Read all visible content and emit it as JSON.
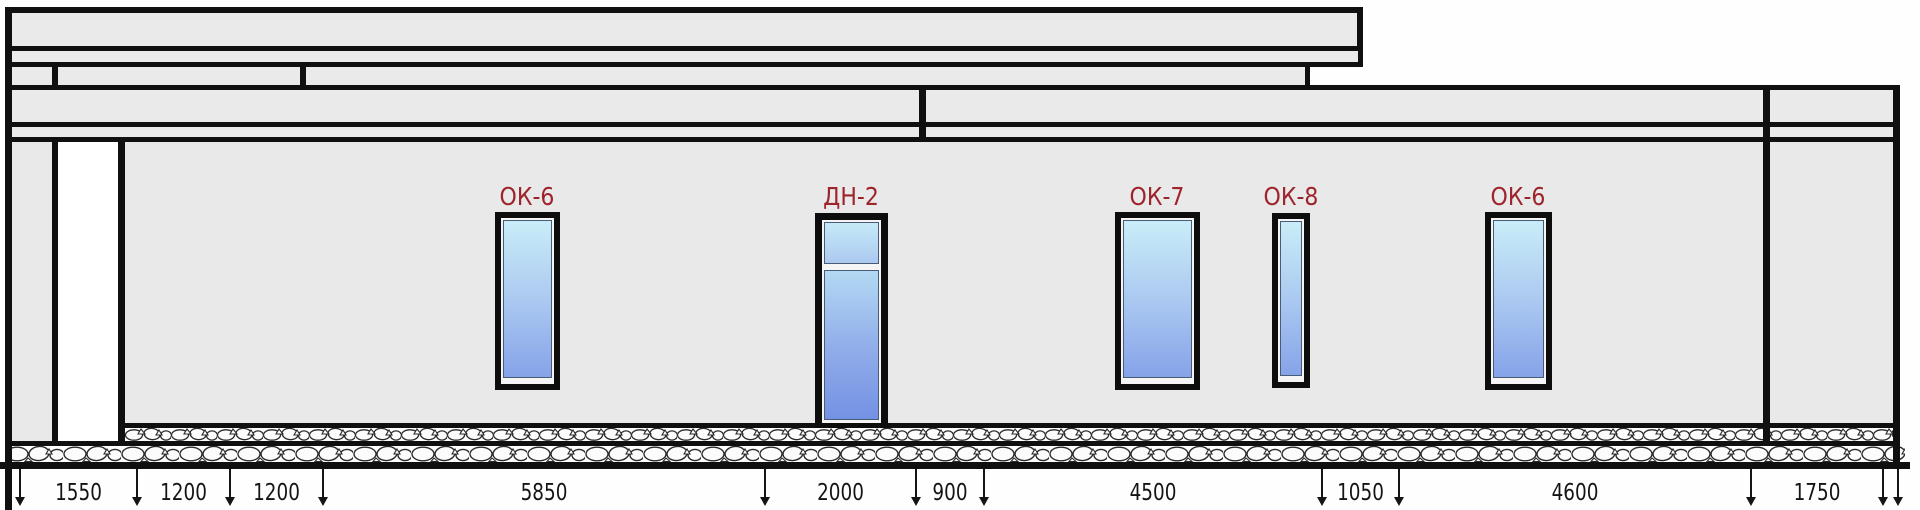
{
  "openings": [
    {
      "mark": "ОК-6",
      "kind": "window"
    },
    {
      "mark": "ДН-2",
      "kind": "door"
    },
    {
      "mark": "ОК-7",
      "kind": "window"
    },
    {
      "mark": "ОК-8",
      "kind": "window"
    },
    {
      "mark": "ОК-6",
      "kind": "window"
    }
  ],
  "dimensions_mm": [
    "1550",
    "1200",
    "1200",
    "5850",
    "2000",
    "900",
    "4500",
    "1050",
    "4600",
    "1750"
  ],
  "colors": {
    "outline_black": "#101010",
    "wall_grey": "#e9e9e9",
    "mark_red": "#9e242c",
    "glass_top": "#c9edf8",
    "glass_bottom": "#86a3e9"
  }
}
